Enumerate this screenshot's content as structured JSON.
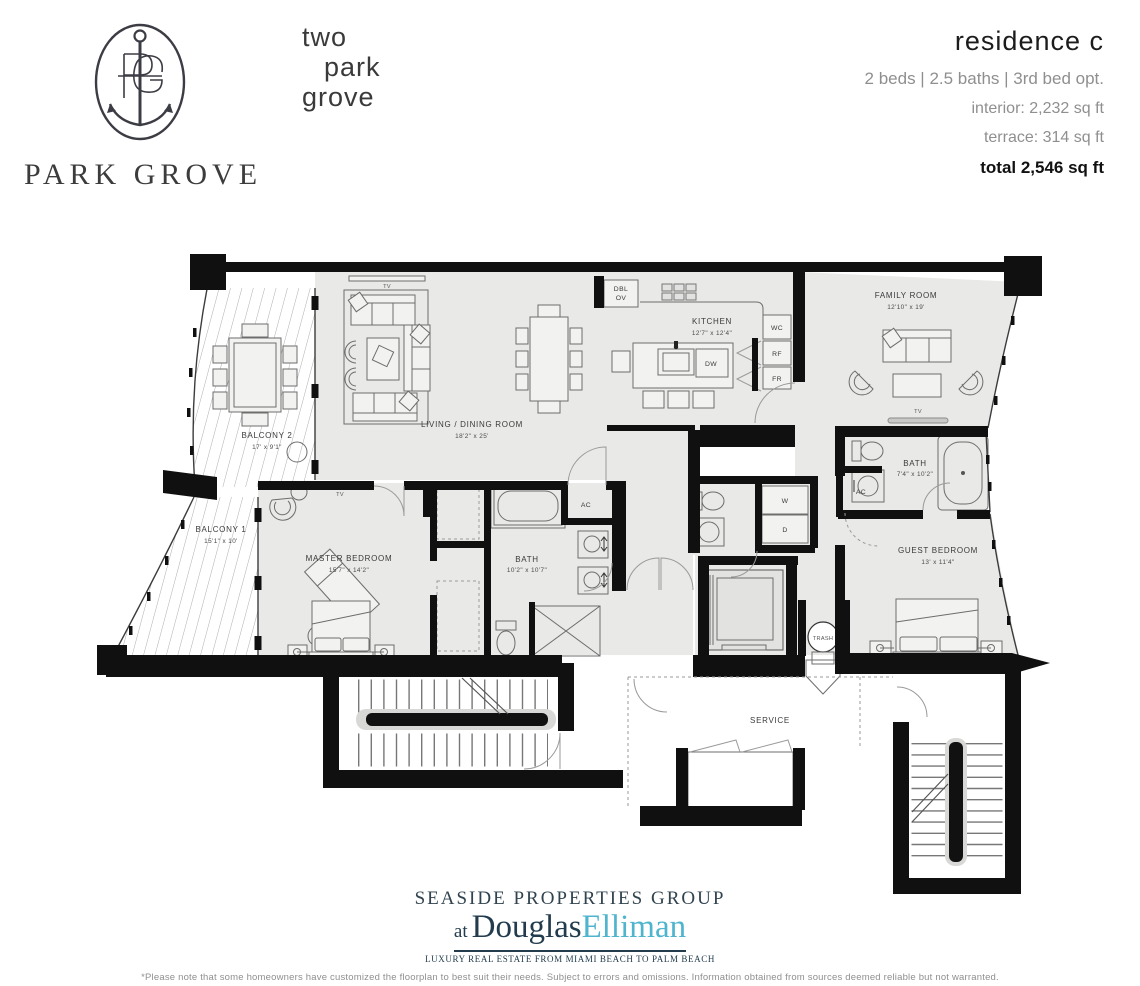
{
  "header": {
    "brand": "PARK GROVE",
    "building": [
      "two",
      "park",
      "grove"
    ],
    "residence": {
      "title": "residence  c",
      "specs": "2 beds  |  2.5 baths  |  3rd bed opt.",
      "interior": "interior: 2,232 sq ft",
      "terrace": "terrace: 314 sq ft",
      "total": "total 2,546 sq ft"
    }
  },
  "plan": {
    "living": {
      "name": "LIVING / DINING ROOM",
      "dims": "18'2\" x 25'"
    },
    "kitchen": {
      "name": "KITCHEN",
      "dims": "12'7\" x 12'4\""
    },
    "family": {
      "name": "FAMILY ROOM",
      "dims": "12'10\" x 19'"
    },
    "master": {
      "name": "MASTER BEDROOM",
      "dims": "15'7\" x 14'2\""
    },
    "master_bath": {
      "name": "BATH",
      "dims": "10'2\" x 10'7\""
    },
    "guest": {
      "name": "GUEST BEDROOM",
      "dims": "13' x 11'4\""
    },
    "guest_bath": {
      "name": "BATH",
      "dims": "7'4\" x 10'2\""
    },
    "balcony1": {
      "name": "BALCONY 1",
      "dims": "15'1\" x 10'"
    },
    "balcony2": {
      "name": "BALCONY 2",
      "dims": "17' x 9'1\""
    },
    "service": "SERVICE",
    "trash": "TRASH",
    "labels": {
      "tv": "TV",
      "ac": "AC",
      "dw": "DW",
      "wc": "WC",
      "rf": "RF",
      "fr": "FR",
      "w": "W",
      "d": "D",
      "dbl": "DBL",
      "ov": "OV"
    }
  },
  "footer": {
    "group": "SEASIDE PROPERTIES GROUP",
    "at": "at",
    "brand1": "Douglas",
    "brand2": "Elliman",
    "tagline": "LUXURY REAL ESTATE FROM MIAMI BEACH TO PALM BEACH",
    "disclaimer": "*Please note that some homeowners have customized the floorplan to best suit their needs. Subject to errors and omissions. Information obtained from sources deemed reliable but not warranted."
  },
  "colors": {
    "wall": "#101010",
    "floor": "#e9e9e7",
    "navy": "#223c4e",
    "elliman_teal": "#4fb4cd"
  }
}
